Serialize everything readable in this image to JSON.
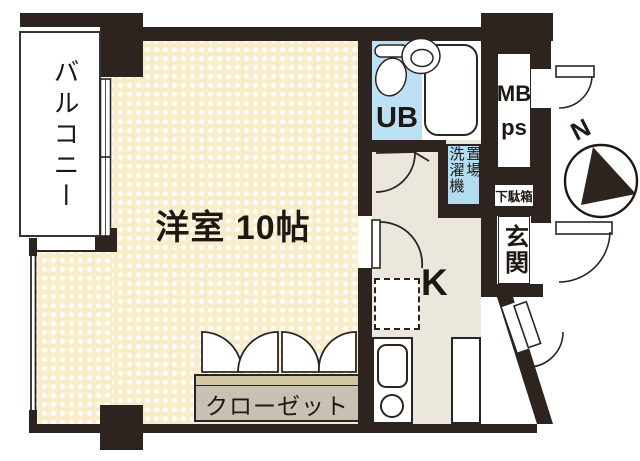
{
  "floorplan": {
    "labels": {
      "balcony": "バルコニー",
      "main_room": "洋室 10帖",
      "unit_bath": "UB",
      "washer_col_left": "洗濯機",
      "washer_col_right": "置場",
      "meter_box": "MB",
      "pipe_space": "ps",
      "shoe_cabinet": "下駄箱",
      "entrance": "玄関",
      "kitchen": "K",
      "closet": "クローゼット",
      "compass_north": "N"
    },
    "colors": {
      "wall": "#2d2420",
      "room_fill": "#f8ecc9",
      "room_dot": "#ffffff",
      "bath_fill": "#bce1f4",
      "washer_fill": "#b4dcf0",
      "floor_fill": "#ece7dd",
      "closet_fill": "#c8c0b2",
      "closet_trim": "#d3c7a2",
      "line": "#2a2522"
    }
  }
}
